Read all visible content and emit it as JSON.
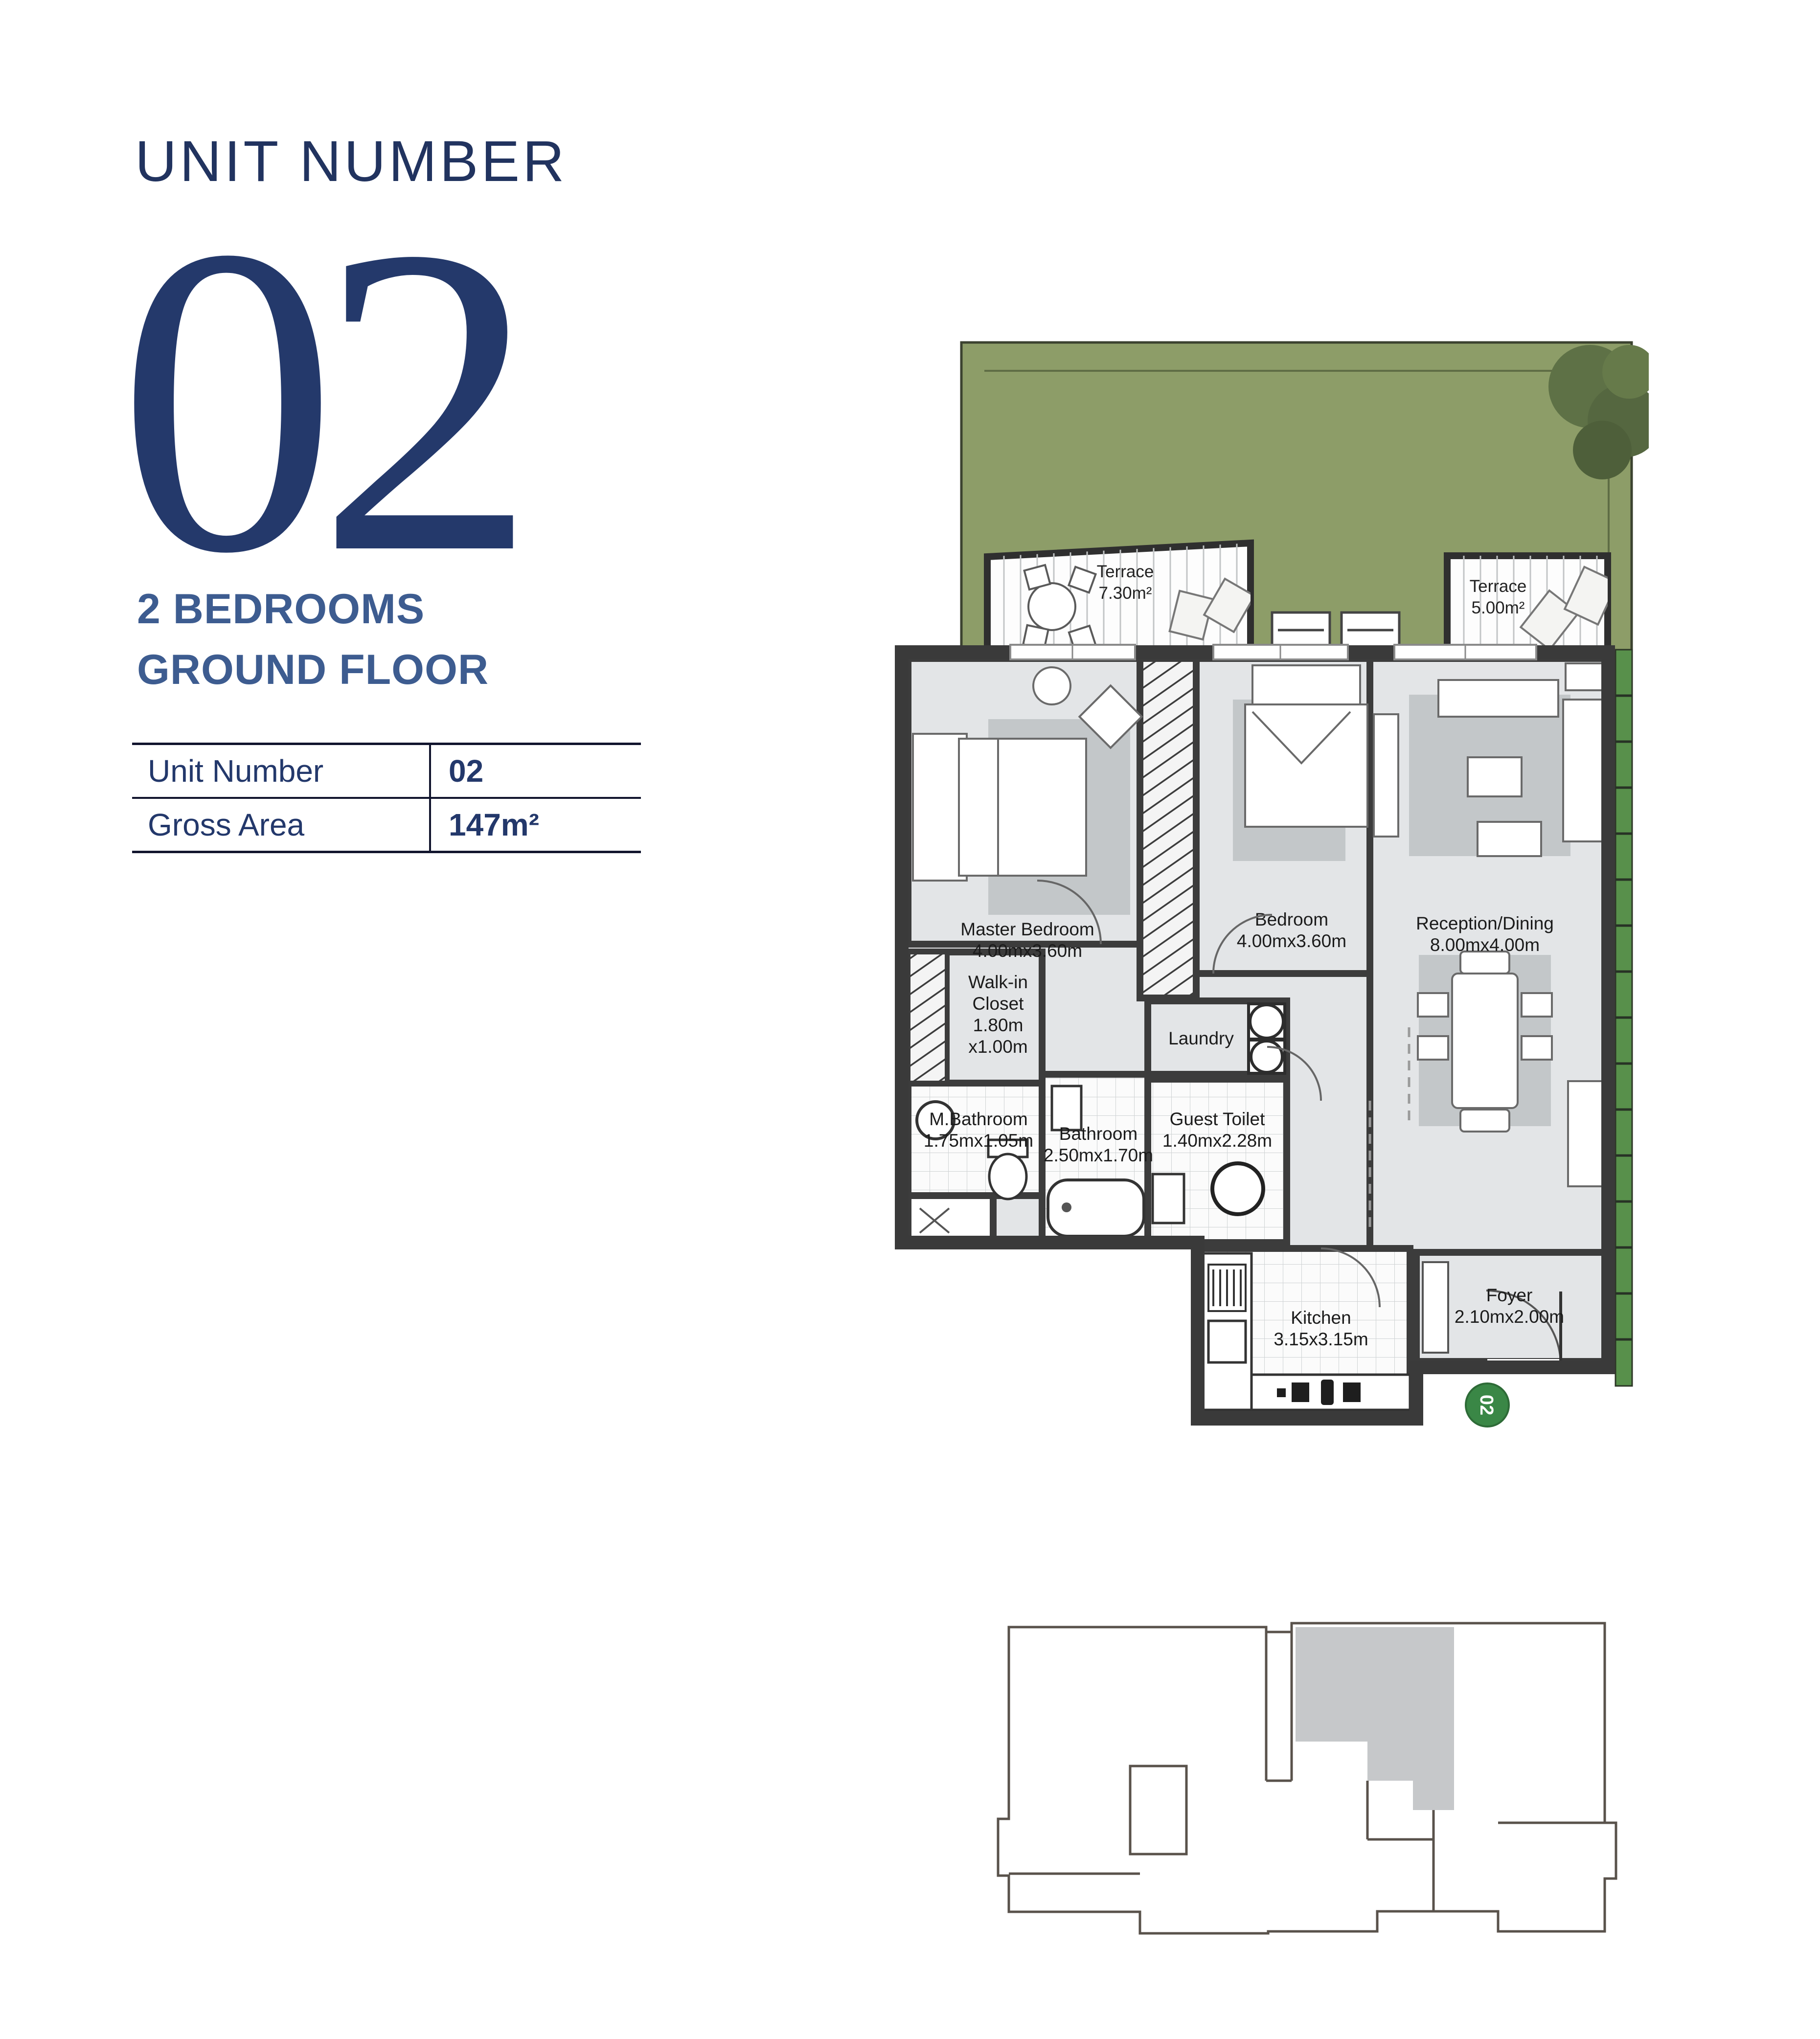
{
  "header": {
    "title": "UNIT NUMBER",
    "number": "02"
  },
  "subtitle": {
    "line1": "2 BEDROOMS",
    "line2": "GROUND FLOOR"
  },
  "info_table": {
    "rows": [
      {
        "label": "Unit Number",
        "value": "02"
      },
      {
        "label": "Gross Area",
        "value": "147m²"
      }
    ]
  },
  "floor_plan": {
    "terrace_left": [
      "Terrace",
      "7.30m²"
    ],
    "terrace_right": [
      "Terrace",
      "5.00m²"
    ],
    "master_bedroom": [
      "Master Bedroom",
      "4.00mx3.60m"
    ],
    "bedroom": [
      "Bedroom",
      "4.00mx3.60m"
    ],
    "reception": [
      "Reception/Dining",
      "8.00mx4.00m"
    ],
    "walk_in_closet": [
      "Walk-in",
      "Closet",
      "1.80m",
      "x1.00m"
    ],
    "m_bathroom": [
      "M.Bathroom",
      "1.75mx1.05m"
    ],
    "bathroom": [
      "Bathroom",
      "2.50mx1.70m"
    ],
    "laundry": [
      "Laundry"
    ],
    "guest_toilet": [
      "Guest Toilet",
      "1.40mx2.28m"
    ],
    "kitchen": [
      "Kitchen",
      "3.15x3.15m"
    ],
    "foyer": [
      "Foyer",
      "2.10mx2.00m"
    ],
    "entry_badge": "02"
  },
  "colors": {
    "navy_title": "#21335f",
    "steel_blue_heading": "#3d5c90",
    "table_text": "#23386b",
    "garden_green": "#8d9d68",
    "hedge_green": "#58904b",
    "entry_badge_green": "#3a8746",
    "wall_dark": "#3c3c3c",
    "room_gray": "#e3e5e7"
  }
}
